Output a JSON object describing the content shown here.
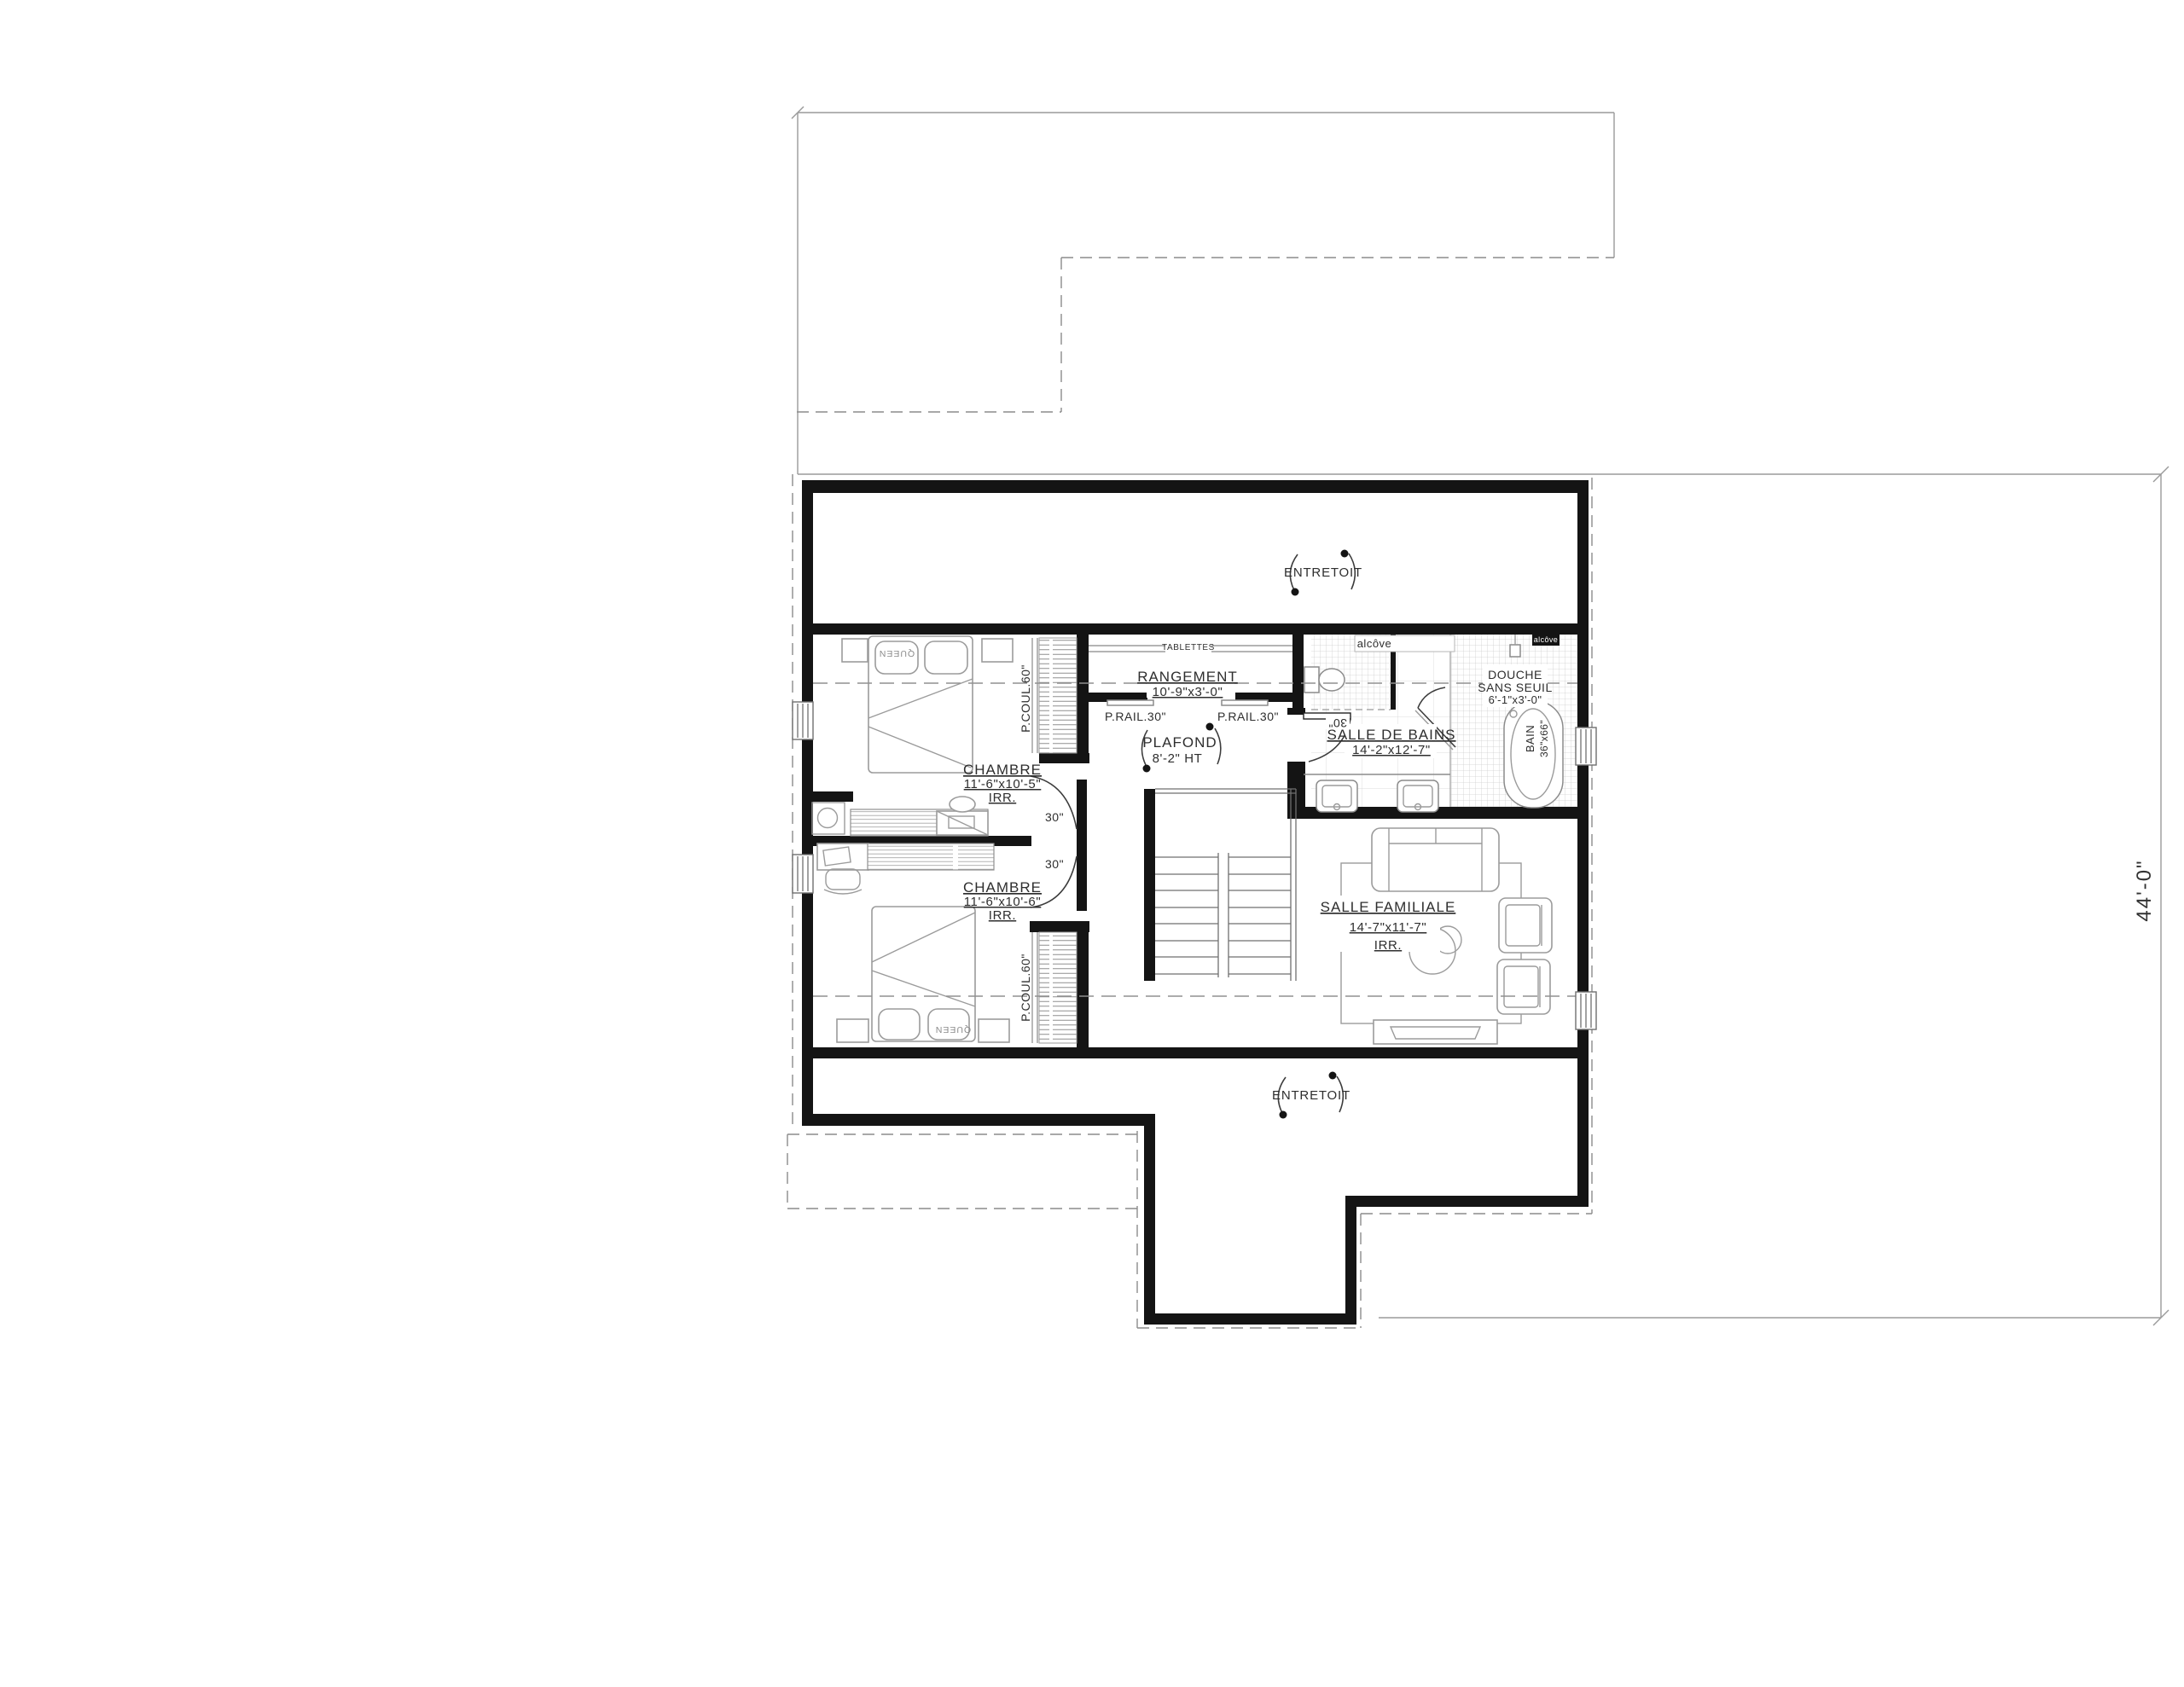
{
  "dimensions": {
    "overall_height": "44'-0\""
  },
  "attic": {
    "top_label": "ENTRETOIT",
    "bottom_label": "ENTRETOIT"
  },
  "hall": {
    "ceiling_label": "PLAFOND",
    "ceiling_height": "8'-2\" HT"
  },
  "storage": {
    "name": "RANGEMENT",
    "dims": "10'-9\"x3'-0\"",
    "shelf_label": "TABLETTES",
    "rail_left": "P.RAIL.30\"",
    "rail_right": "P.RAIL.30\""
  },
  "bedroom1": {
    "name": "CHAMBRE",
    "dims": "11'-6\"x10'-5\"",
    "irr": "IRR.",
    "bed_label": "QUEEN",
    "closet_label": "P.COUL.60\"",
    "door_label": "30\""
  },
  "bedroom2": {
    "name": "CHAMBRE",
    "dims": "11'-6\"x10'-6\"",
    "irr": "IRR.",
    "bed_label": "QUEEN",
    "closet_label": "P.COUL.60\"",
    "door_label": "30\""
  },
  "bathroom": {
    "name": "SALLE DE BAINS",
    "dims": "14'-2\"x12'-7\"",
    "door_label": "30\"",
    "alcove_label": "alcôve",
    "alcove_tag": "alcôve",
    "shower_line1": "DOUCHE",
    "shower_line2": "SANS SEUIL",
    "shower_dims": "6'-1\"x3'-0\"",
    "tub_name": "BAIN",
    "tub_dims": "36\"x66\""
  },
  "family_room": {
    "name": "SALLE FAMILIALE",
    "dims": "14'-7\"x11'-7\"",
    "irr": "IRR."
  },
  "colors": {
    "wall": "#141414",
    "construction_line": "#9a9a9a",
    "dashed_line": "#8c8c8c",
    "furniture_line": "#9b9b9b",
    "text": "#2e2e2e",
    "background": "#ffffff"
  }
}
